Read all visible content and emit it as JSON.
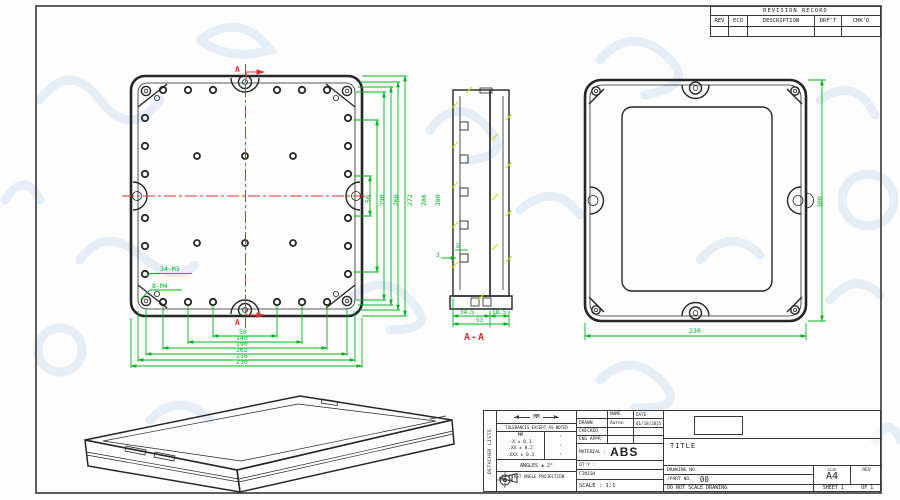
{
  "colors": {
    "line": "#262626",
    "dimension_green": "#00b41e",
    "centerline_red": "#e03131",
    "hatch_yellow": "#d8d800",
    "watermark_blue": "#d9e7f5"
  },
  "revision_table": {
    "title": "REVISION RECORD",
    "columns": [
      "REV",
      "ECO",
      "DESCRIPTION",
      "DRF'T",
      "CHK'D"
    ]
  },
  "top_view": {
    "thread_label_m3": "34-M3",
    "thread_label_m4": "8-M4",
    "section_letter_top": "A",
    "section_letter_bottom": "A",
    "width_chain_dims": [
      "50",
      "140",
      "190",
      "202",
      "216",
      "230"
    ],
    "height_chain_dims": [
      "50",
      "190",
      "260",
      "272",
      "286",
      "300"
    ]
  },
  "section_view": {
    "label": "A-A",
    "dim_body": "34.5",
    "dim_lid": "18.5",
    "dim_total": "53",
    "dim_rib_width": "5",
    "dim_rib_depth": "3"
  },
  "back_view": {
    "dim_width": "230",
    "dim_height": "300"
  },
  "title_block": {
    "side_strip": "DETACHED LISTS",
    "units_label": "MM",
    "tolerance_note": "TOLERANCES EXCEPT AS NOTED",
    "tol_unit_header": "MM",
    "tol_rows": [
      ".X ± 0.3",
      ".XX ± 0.2",
      ".XXX ± 0.1"
    ],
    "tol_marks": [
      "·",
      "·",
      "·"
    ],
    "angles_note": "ANGLES ± 2°",
    "projection_note": "FIRST ANGLE PROJECTION",
    "name_header": "NAME",
    "date_header": "DATE",
    "drawn_label": "DRAWN",
    "drawn_name": "Aaron",
    "drawn_date": "01/18/2015",
    "checked_label": "CHECKED",
    "eng_appr_label": "ENG APPR",
    "material_label": "MATERIAL :",
    "material_value": "ABS",
    "qty_label": "QT'Y :",
    "finish_label": "FINISH",
    "scale_label": "SCALE : 1:1",
    "title_label": "TITLE",
    "drawing_no_label": "DRAWING NO.",
    "part_no_label": "/PART NO.",
    "part_no_value": "00",
    "size_label": "SIZE",
    "size_value": "A4",
    "rev_label": "REV",
    "do_not_scale": "DO NOT SCALE DRAWING",
    "sheet_info": "SHEET 1",
    "of_info": "OF 1"
  }
}
